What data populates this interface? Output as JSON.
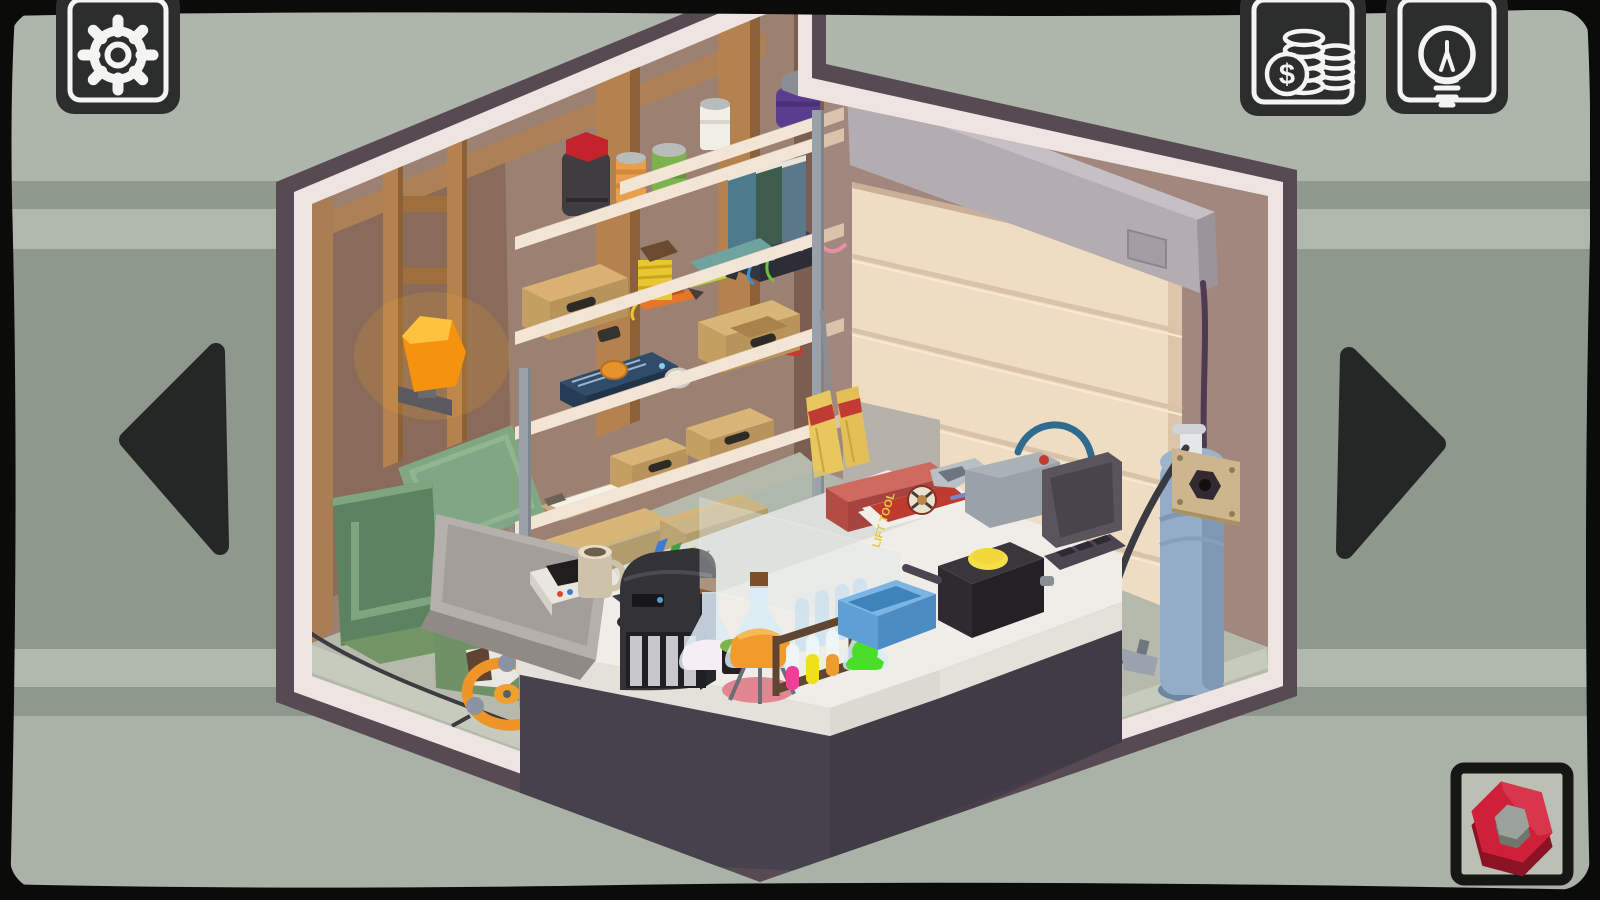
{
  "app": {
    "name": "Isometric Room Puzzle",
    "scene_description": "garage workshop room, isometric cutaway view"
  },
  "hud": {
    "settings_button": {
      "label": "Settings",
      "icon": "gear-icon"
    },
    "coins_button": {
      "label": "Coins",
      "icon": "coins-icon",
      "currency_symbol": "$"
    },
    "hint_button": {
      "label": "Hint",
      "icon": "lightbulb-icon"
    },
    "nav_prev": {
      "label": "Rotate view left",
      "icon": "arrow-left-icon"
    },
    "nav_next": {
      "label": "Rotate view right",
      "icon": "arrow-right-icon"
    },
    "inventory_slot": {
      "item": "red hex nut"
    }
  },
  "scene": {
    "magazine_title": "LIFT TOOL",
    "objects": [
      "wall lamp",
      "folding chair",
      "green armchair",
      "white boot",
      "orange valve wheel",
      "shelving unit",
      "white can",
      "purple jar",
      "dark jar with red lid",
      "orange can",
      "green can",
      "books",
      "teal folder",
      "cardboard boxes",
      "box cutter",
      "thread spool",
      "highlighter",
      "battery charger",
      "pink wire",
      "radio with orange button",
      "red crowbar",
      "tape roll",
      "clipboard",
      "broom",
      "laptop",
      "hard hat",
      "coffee mug",
      "white box",
      "remote",
      "red button",
      "printer with ink cartridges",
      "flask with white liquid",
      "herb cup",
      "flask with orange liquid on stand",
      "glass pane",
      "test tube rack",
      "test tubes pink yellow orange",
      "flask with green liquid",
      "blue tray",
      "black box with yellow button",
      "welding machine",
      "blue cable",
      "control remote",
      "red toolbox",
      "magazine",
      "pen",
      "garage door",
      "door roller housing",
      "vent panel",
      "purple cable",
      "socket plate with hex hole",
      "gas cylinder",
      "gas hose",
      "torch nozzle"
    ]
  },
  "colors": {
    "frame_black": "#0b0b09",
    "bg_light": "#aeb5aa",
    "bg_dark": "#8e988d",
    "bg_bottom": "#aab1a6",
    "button_bg": "#2b2e2d",
    "icon_white": "#f4f4f2",
    "arrow_dark": "#242725",
    "rim_white": "#eee4e1",
    "shell_purple": "#584a53",
    "left_wall": "#9c8172",
    "right_wall": "#a1877d",
    "door_tan": "#eedcc3",
    "floor_green": "#b5baad",
    "desk_top": "#f0ede9",
    "desk_base": "#46414c",
    "nut_red": "#cf2039",
    "nut_red_dark": "#8c1324",
    "nut_hole_grey": "#9ba19b"
  }
}
